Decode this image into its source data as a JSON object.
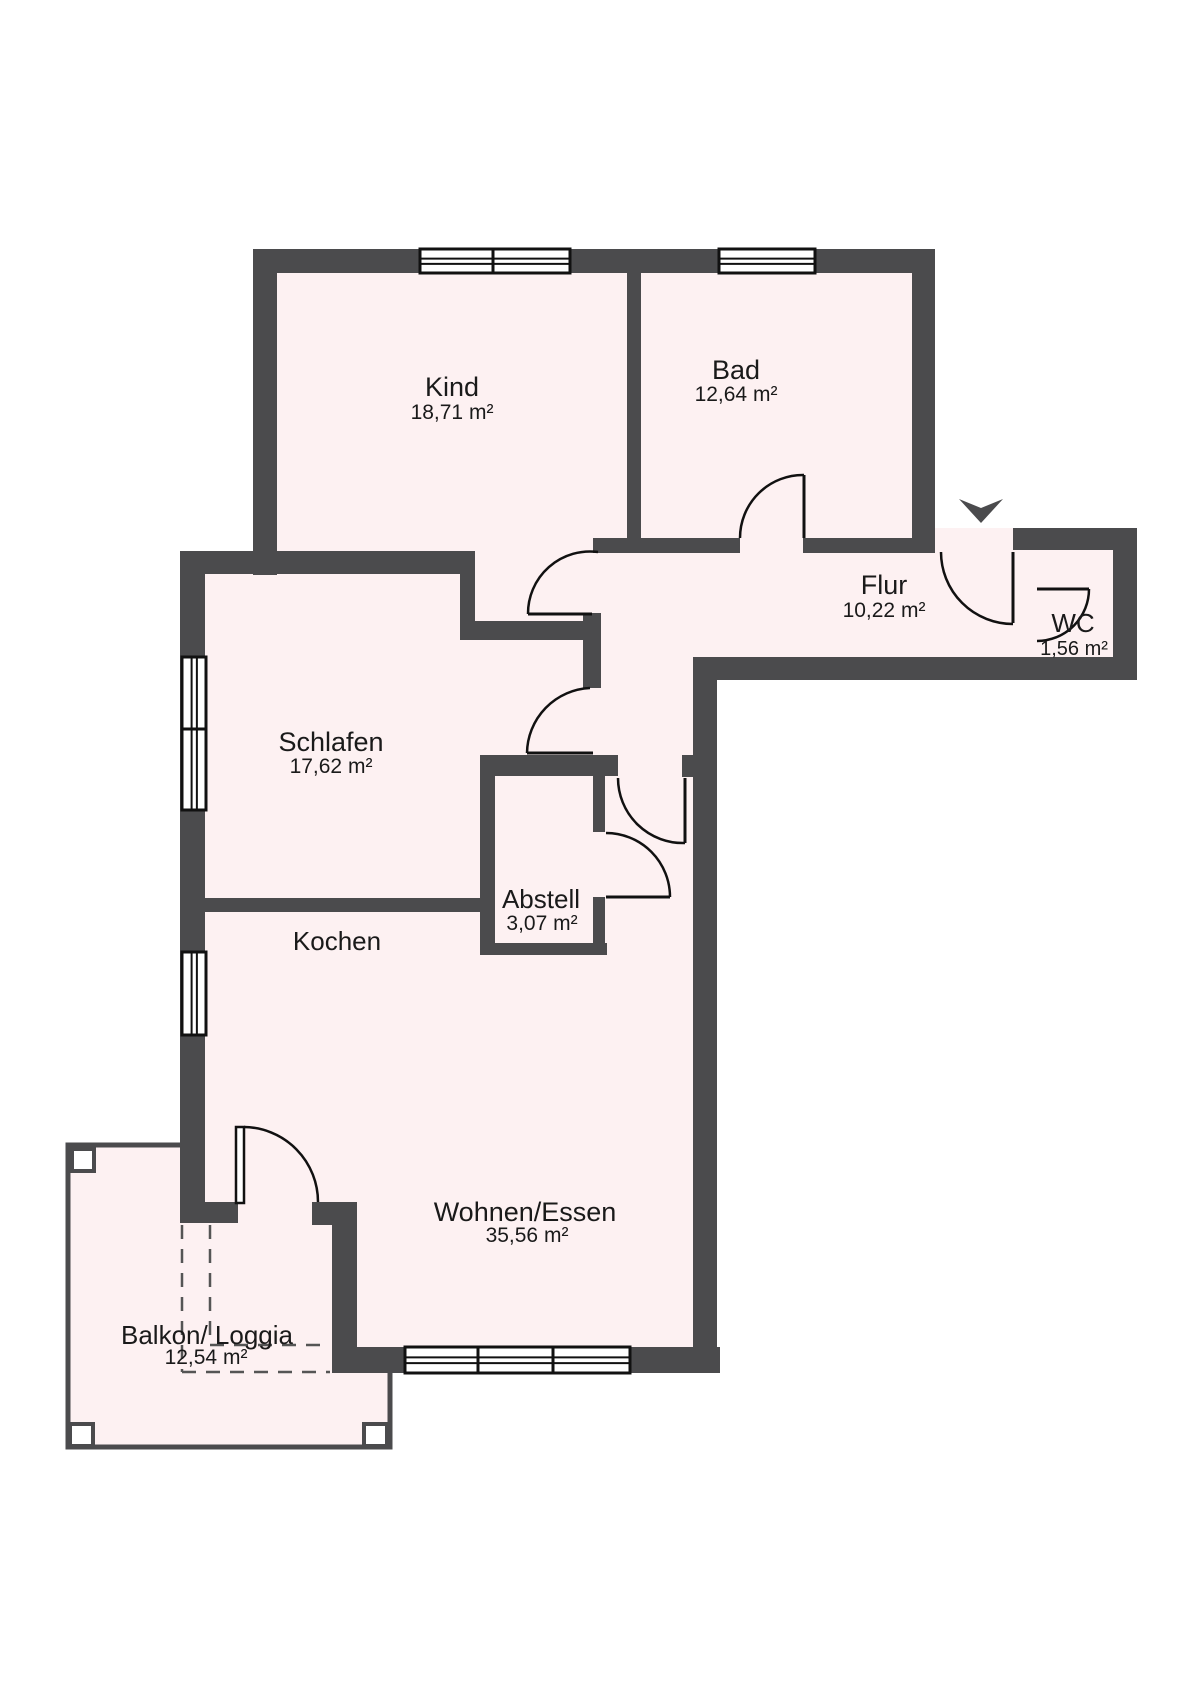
{
  "rooms": [
    {
      "id": "kind",
      "name": "Kind",
      "area": "18,71 m²"
    },
    {
      "id": "bad",
      "name": "Bad",
      "area": "12,64 m²"
    },
    {
      "id": "flur",
      "name": "Flur",
      "area": "10,22 m²"
    },
    {
      "id": "wc",
      "name": "WC",
      "area": "1,56 m²"
    },
    {
      "id": "schlafen",
      "name": "Schlafen",
      "area": "17,62 m²"
    },
    {
      "id": "kochen",
      "name": "Kochen",
      "area": ""
    },
    {
      "id": "abstell",
      "name": "Abstell",
      "area": "3,07 m²"
    },
    {
      "id": "wohnen",
      "name": "Wohnen/Essen",
      "area": "35,56 m²"
    },
    {
      "id": "balkon",
      "name": "Balkon/ Loggia",
      "area": "12,54 m²"
    }
  ],
  "icons": {
    "entrance_arrow": "entrance-direction-arrow"
  },
  "colors": {
    "wall": "#4b4b4d",
    "room_fill": "#fdf1f2",
    "outline": "#111111",
    "text": "#1a1a1a",
    "dash": "#555555",
    "background": "#ffffff",
    "window_fill": "#ffffff",
    "post_fill": "#ffffff"
  }
}
